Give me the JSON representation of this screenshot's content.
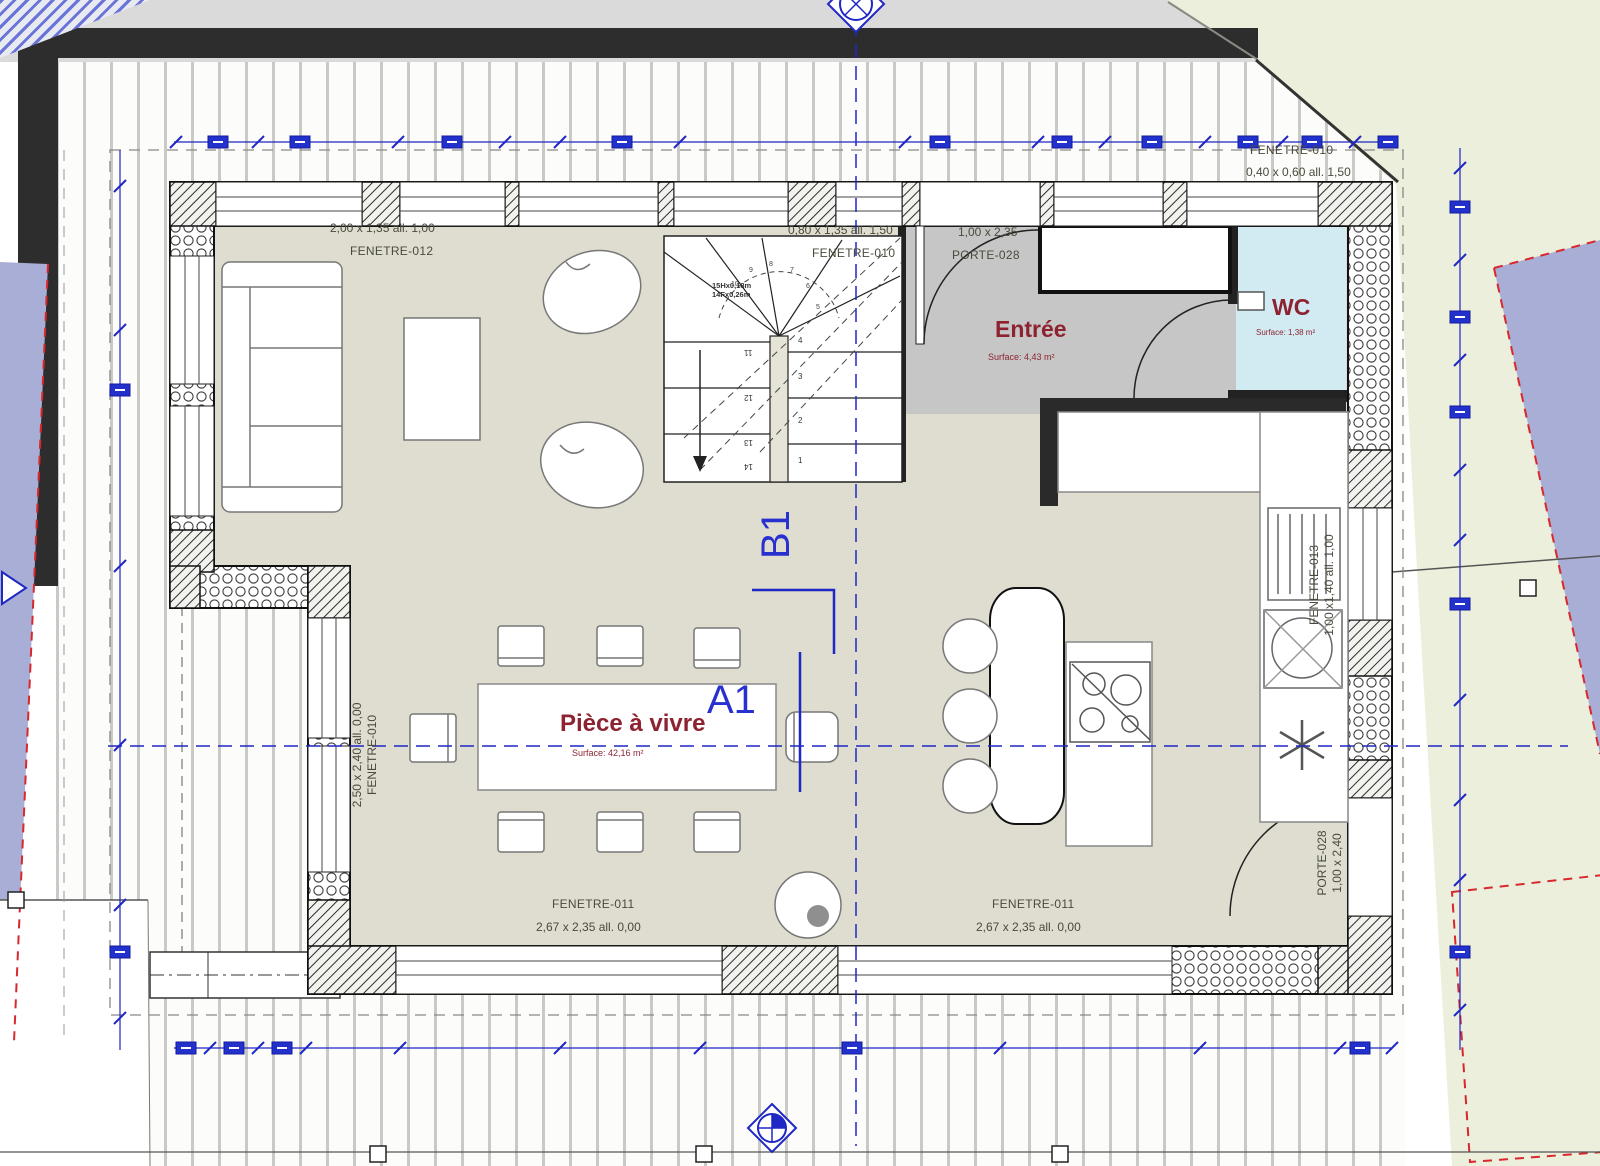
{
  "drawing": {
    "sections": {
      "a": "A1",
      "b": "B1"
    },
    "rooms": {
      "living": {
        "name": "Pièce à vivre",
        "surface": "Surface: 42,16 m²"
      },
      "entry": {
        "name": "Entrée",
        "surface": "Surface: 4,43 m²"
      },
      "wc": {
        "name": "WC",
        "surface": "Surface: 1,38 m²"
      }
    },
    "openings": {
      "f012": {
        "name": "FENETRE-012",
        "dims": "2,00 x 1,35 all. 1,00"
      },
      "f010_top": {
        "name": "FENETRE-010",
        "dims": "0,80 x 1,35 all. 1,50"
      },
      "p028_top": {
        "name": "PORTE-028",
        "dims": "1,00 x 2,35"
      },
      "f010_ne": {
        "name": "FENETRE-010",
        "dims": "0,40 x 0,60 all. 1,50"
      },
      "f011_a": {
        "name": "FENETRE-011",
        "dims": "2,67 x 2,35 all. 0,00"
      },
      "f011_b": {
        "name": "FENETRE-011",
        "dims": "2,67 x 2,35 all. 0,00"
      },
      "f010_left": {
        "name": "FENETRE-010",
        "dims": "2,50 x 2,40 all. 0,00"
      },
      "f013_right": {
        "name": "FENETRE-013",
        "dims": "1,00 x1,40 all. 1,00"
      },
      "p028_right": {
        "name": "PORTE-028",
        "dims": "1,00 x 2,40"
      }
    },
    "stair": {
      "note1": "15Hx0,18m",
      "note2": "14Fx0,26m",
      "left": [
        "11",
        "12",
        "13",
        "14"
      ],
      "right": [
        "4",
        "3",
        "2",
        "1"
      ],
      "fan": [
        "5",
        "6",
        "7",
        "8",
        "9",
        "10"
      ]
    },
    "colors": {
      "annotation": "#1f27c4",
      "room_label": "#8d2330",
      "site_purple": "#a9aed7",
      "floor": "#deddcf",
      "entry_floor": "#c6c6c6",
      "wc_floor": "#d2ebf3"
    }
  }
}
